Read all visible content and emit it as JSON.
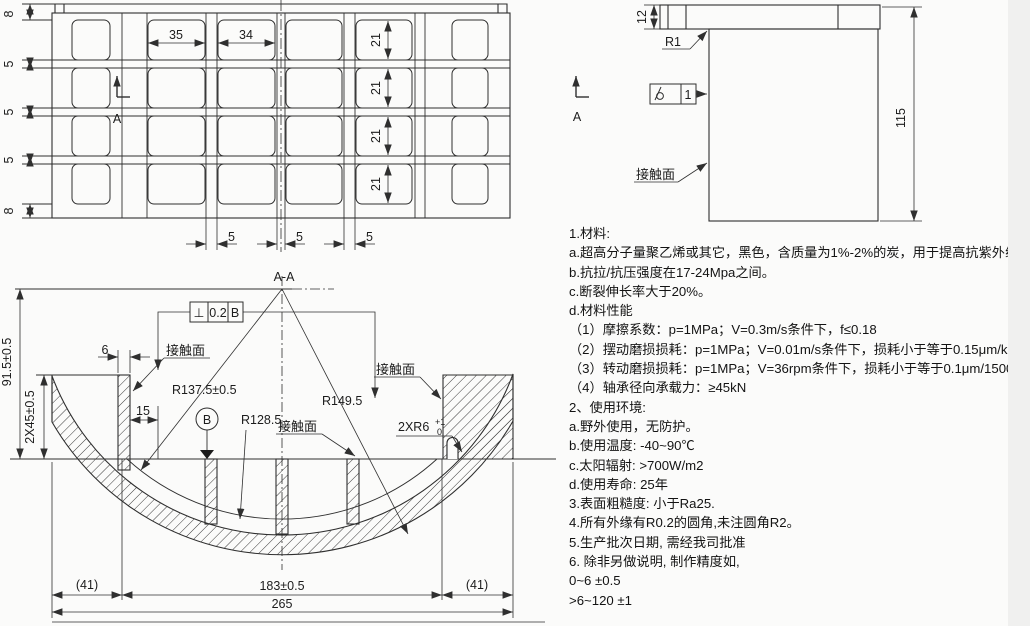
{
  "page": {
    "bg": "#fbfbfa",
    "line_color": "#2f2f2f"
  },
  "plan_view": {
    "dim_col2_width": "35",
    "dim_col3_width": "34",
    "dim_row_heights": [
      "21",
      "21",
      "21",
      "21"
    ],
    "dims_left": [
      "8",
      "5",
      "5",
      "5",
      "8"
    ],
    "dims_bottom": [
      "5",
      "5",
      "5"
    ],
    "section_arrow_label": "A"
  },
  "side_view": {
    "dim_flange_thickness": "12",
    "dim_height": "115",
    "fillet_radius": "R1",
    "surface_finish_grade": "1",
    "contact_surface_label": "接触面",
    "section_arrow_label": "A"
  },
  "section_view": {
    "title": "A-A",
    "gdt": {
      "symbol": "⊥",
      "tolerance": "0.2",
      "datum": "B"
    },
    "datum_label": "B",
    "contact_surface_left": "接触面",
    "contact_surface_middle": "接触面",
    "contact_surface_right": "接触面",
    "radius_inner": "R137.5±0.5",
    "radius_pad": "R128.5",
    "radius_outer": "R149.5",
    "groove_radius": "2XR6",
    "groove_tol_upper": "+1",
    "groove_tol_lower": "0",
    "dim_overall_height": "91.5±0.5",
    "dim_flange_height": "2X45±0.5",
    "dim_rib_width": "6",
    "dim_pocket_width": "15",
    "dim_left_offset": "(41)",
    "dim_span": "183±0.5",
    "dim_right_offset": "(41)",
    "dim_overall_width": "265"
  },
  "notes": {
    "lines": [
      "1.材料:",
      "a.超高分子量聚乙烯或其它，黑色，含质量为1%-2%的炭，用于提高抗紫外线的能力。",
      "b.抗拉/抗压强度在17-24Mpa之间。",
      "c.断裂伸长率大于20%。",
      "d.材料性能",
      "（1）摩擦系数：p=1MPa；V=0.3m/s条件下，f≤0.18",
      "（2）摆动磨损损耗：p=1MPa；V=0.01m/s条件下，损耗小于等于0.15μm/km",
      "（3）转动磨损损耗：p=1MPa；V=36rpm条件下，损耗小于等于0.1μm/1500rp",
      "（4）轴承径向承载力：≥45kN",
      "2、使用环境:",
      "a.野外使用，无防护。",
      "b.使用温度: -40~90℃",
      "c.太阳辐射: >700W/m2",
      "d.使用寿命: 25年",
      "3.表面粗糙度: 小于Ra25.",
      "4.所有外缘有R0.2的圆角,未注圆角R2。",
      "5.生产批次日期, 需经我司批准",
      "6. 除非另做说明, 制作精度如,",
      "0~6 ±0.5",
      ">6~120 ±1"
    ]
  }
}
